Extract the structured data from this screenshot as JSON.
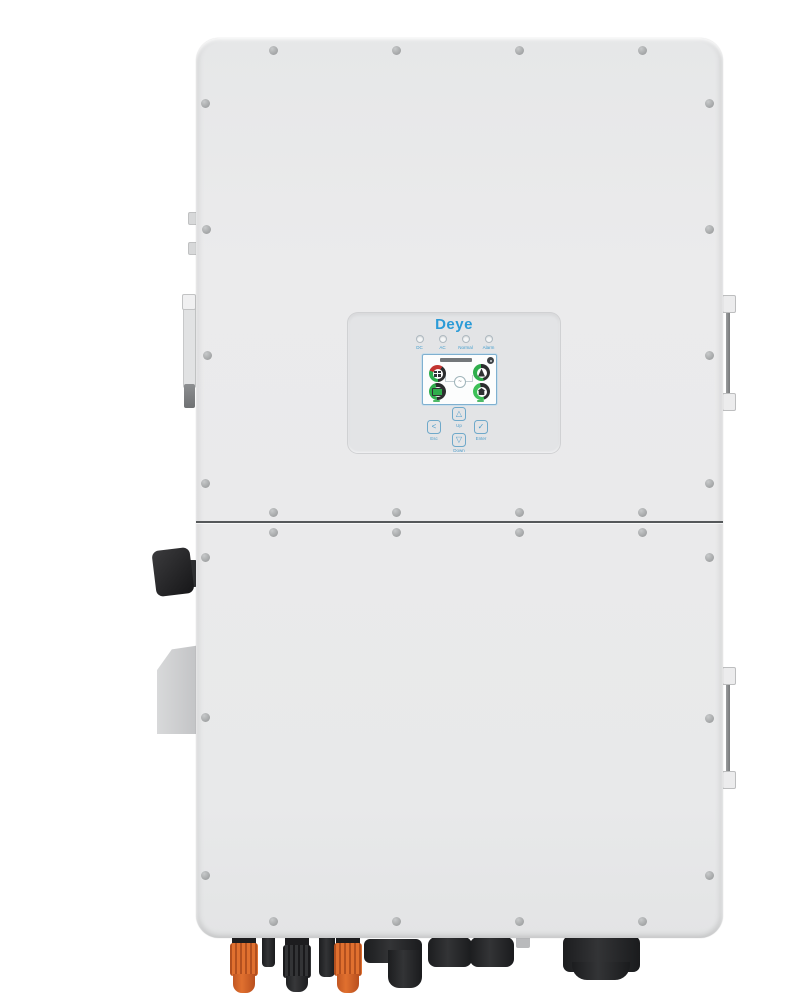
{
  "panel": {
    "logo": "Deye",
    "leds": [
      {
        "label": "DC"
      },
      {
        "label": "AC"
      },
      {
        "label": "Normal"
      },
      {
        "label": "Alarm"
      }
    ],
    "buttons": {
      "esc": {
        "glyph": "<",
        "label": "Esc"
      },
      "up": {
        "glyph": "△",
        "label": "Up"
      },
      "down": {
        "glyph": "▽",
        "label": "Down"
      },
      "enter": {
        "glyph": "✓",
        "label": "Enter"
      }
    }
  },
  "screen": {
    "gauges": [
      {
        "name": "pv"
      },
      {
        "name": "grid"
      },
      {
        "name": "battery"
      },
      {
        "name": "load"
      }
    ]
  },
  "colors": {
    "brand_blue": "#2b9bd7",
    "accent_green": "#2fae4c",
    "accent_red": "#c23430",
    "connector_orange": "#d9662a",
    "body_gray": "#eaeaeb"
  }
}
